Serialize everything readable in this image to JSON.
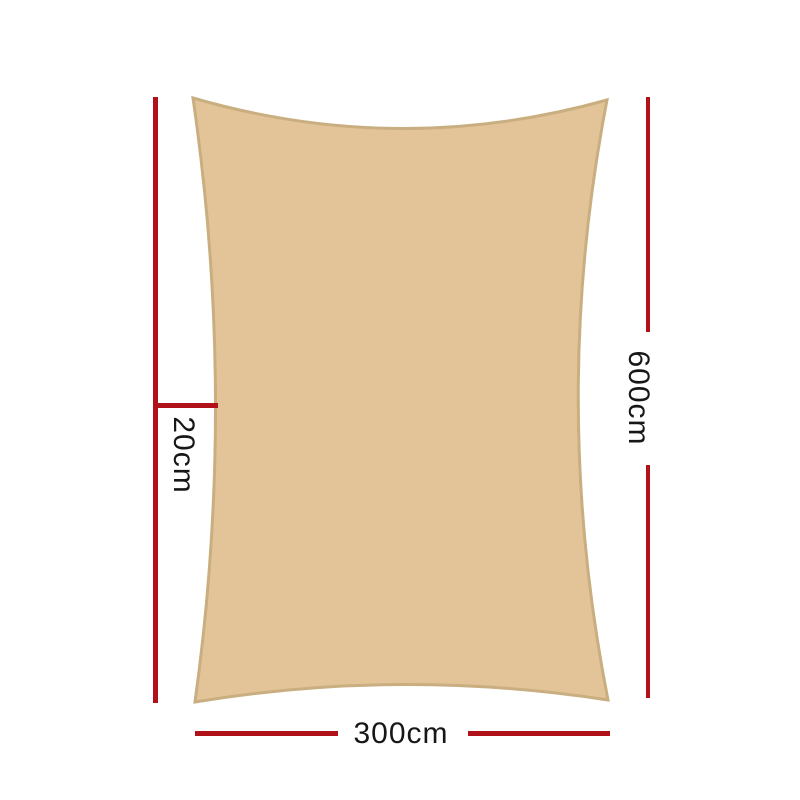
{
  "diagram": {
    "title": "shade-sail-dimension-diagram",
    "product": "rectangle shade sail",
    "sail": {
      "fill_color": "#e3c498",
      "border_color": "#c9ae80"
    },
    "dimension_line_color": "#b11219",
    "label_text_color": "#171717",
    "labels": {
      "width": "300cm",
      "height": "600cm",
      "left_tick": "20cm"
    }
  }
}
